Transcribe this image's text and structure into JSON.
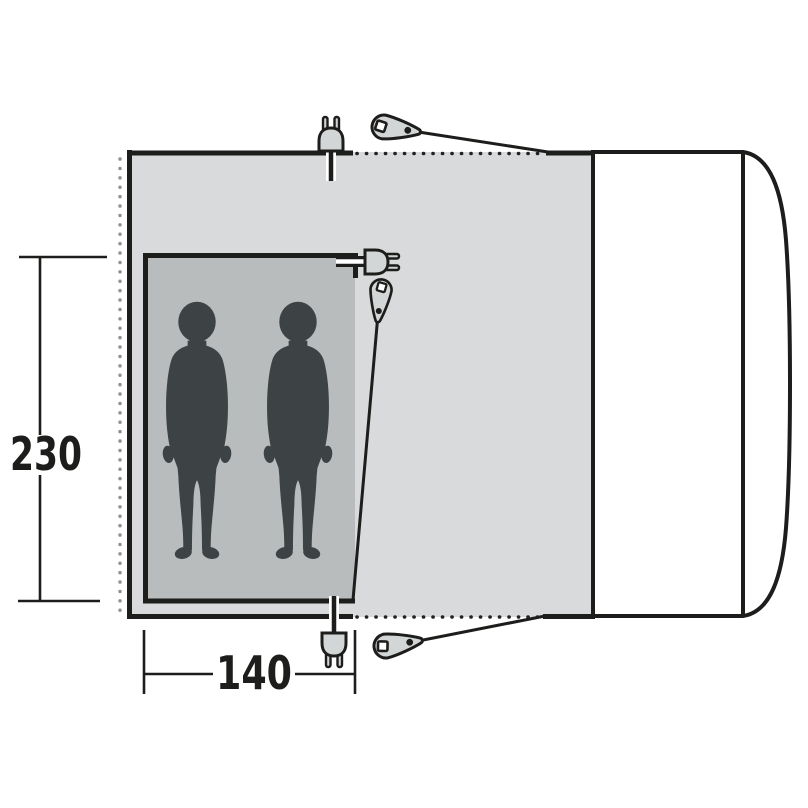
{
  "diagram": {
    "type": "awning-floor-plan-top-view",
    "description": "Top-view floor plan of a drive-away awning attached to a vehicle, with inner sleeping cabin for two persons",
    "dimensions": {
      "height_label": "230",
      "width_label": "140"
    },
    "occupant_count": 2,
    "icons": [
      "power-plug-icon-top",
      "power-plug-icon-middle",
      "power-plug-icon-bottom",
      "guy-peg-icon-top",
      "guy-peg-icon-middle",
      "guy-peg-icon-bottom",
      "person-silhouette-left",
      "person-silhouette-right",
      "vehicle-outline"
    ],
    "colors": {
      "background": "#ffffff",
      "awning_fill": "#d8dadb",
      "inner_tent_fill": "#b9bcbd",
      "figure_fill": "#3d4245",
      "outline": "#1d1d1b",
      "hardware_fill": "#d3d6d7",
      "left_dots": "#8d9192",
      "vehicle_fill": "#ffffff"
    }
  }
}
